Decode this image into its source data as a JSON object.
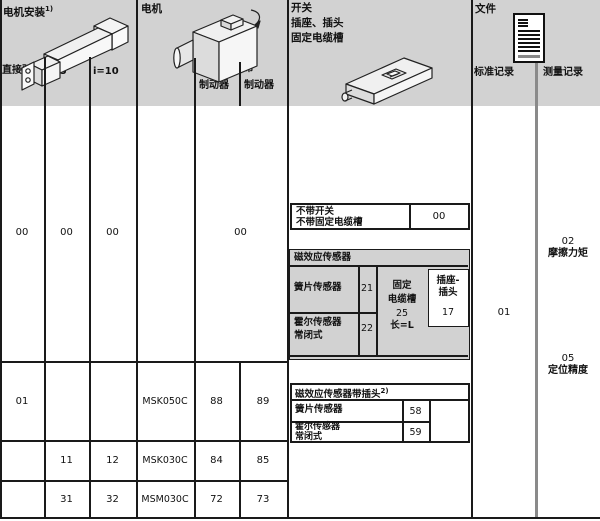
{
  "mount": {
    "title": "电机安装",
    "sup": "1)",
    "col_direct": "直接驱动",
    "col_i5": "i=5",
    "col_i10": "i=10",
    "row00": {
      "direct": "00",
      "i5": "00",
      "i10": "00"
    },
    "rows": [
      {
        "direct": "01",
        "i5": "",
        "i10": ""
      },
      {
        "direct": "",
        "i5": "11",
        "i10": "12"
      },
      {
        "direct": "",
        "i5": "31",
        "i10": "32"
      }
    ]
  },
  "motor": {
    "title": "电机",
    "col_nobrake_l1": "不带",
    "col_nobrake_l2": "制动器",
    "col_brake_l1": "带",
    "col_brake_l2": "制动器",
    "value00": "00",
    "rows": [
      {
        "name": "MSK050C",
        "nobrake": "88",
        "brake": "89"
      },
      {
        "name": "MSK030C",
        "nobrake": "84",
        "brake": "85"
      },
      {
        "name": "MSM030C",
        "nobrake": "72",
        "brake": "73"
      }
    ]
  },
  "switch": {
    "title_l1": "开关",
    "title_l2": "插座、插头",
    "title_l3": "固定电缆槽",
    "none": {
      "label_l1": "不带开关",
      "label_l2": "不带固定电缆槽",
      "value": "00"
    },
    "sensor": {
      "header": "磁效应传感器",
      "reed_label": "簧片传感器",
      "reed_code": "21",
      "hall_label_l1": "霍尔传感器",
      "hall_label_l2": "常闭式",
      "hall_code": "22",
      "duct_l1": "固定",
      "duct_l2": "电缆槽",
      "duct_l3": "25",
      "duct_l4": "长=L",
      "plug_l1": "插座-",
      "plug_l2": "插头",
      "plug_code": "17"
    },
    "sensor_plug": {
      "header": "磁效应传感器带插头",
      "sup": "2)",
      "reed_label": "簧片传感器",
      "reed_code": "58",
      "hall_label_l1": "霍尔传感器",
      "hall_label_l2": "常闭式",
      "hall_code": "59"
    }
  },
  "docs": {
    "title": "文件",
    "col_standard": "标准记录",
    "col_measure": "测量记录",
    "standard_value": "01",
    "measure_items": [
      {
        "code": "02",
        "label": "摩擦力矩"
      },
      {
        "code": "05",
        "label": "定位精度"
      }
    ]
  }
}
